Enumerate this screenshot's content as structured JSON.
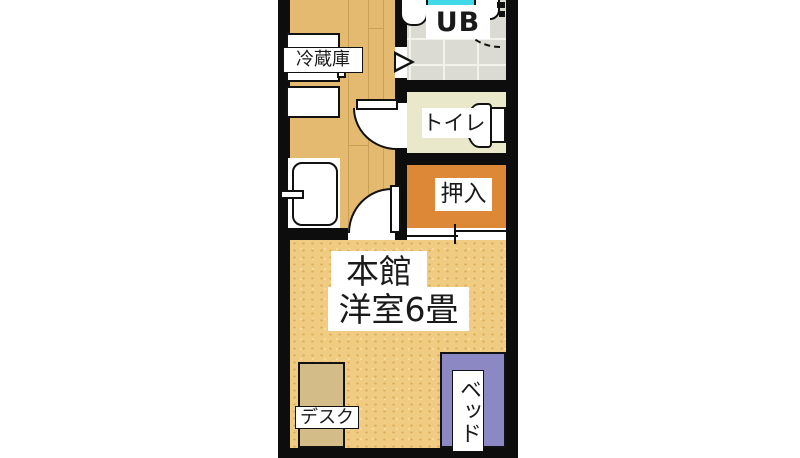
{
  "title": "apartment-floor-plan",
  "colors": {
    "wall": "#0d0d0d",
    "kitchen_floor": "#e3ba6f",
    "main_room_floor": "#f0cc82",
    "closet_floor": "#dd8836",
    "toilet_floor": "#eae8cb",
    "unit_bath_floor": "#dbdbd3",
    "bathtub": "#3fd9e8",
    "bed": "#8b88c3",
    "desk": "#d3bc87",
    "fixture": "#ffffff"
  },
  "rooms": {
    "kitchen": {
      "fridge_label": "冷蔵庫"
    },
    "unit_bath": {
      "label": "UB"
    },
    "toilet": {
      "label": "トイレ"
    },
    "closet": {
      "label": "押入"
    },
    "main_room": {
      "building_label": "本館",
      "size_label": "洋室6畳"
    }
  },
  "furniture": {
    "desk_label": "デスク",
    "bed_label": "ベッド"
  }
}
